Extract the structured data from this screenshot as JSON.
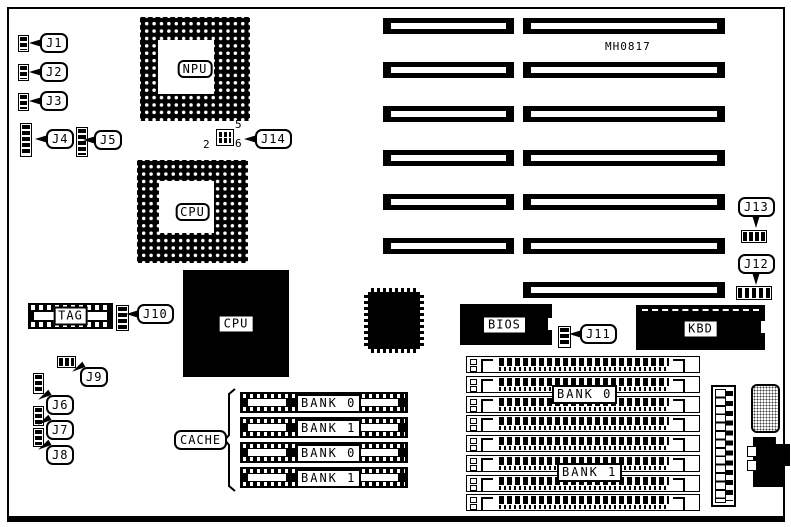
{
  "figure": {
    "part_number": "MH0817",
    "sockets": {
      "npu": "NPU",
      "cpu_upgrade": "CPU"
    },
    "chips": {
      "cpu": "CPU",
      "bios": "BIOS",
      "kbd": "KBD",
      "tag": "TAG"
    },
    "cache": {
      "label": "CACHE",
      "rows": [
        "BANK 0",
        "BANK 1",
        "BANK 0",
        "BANK 1"
      ]
    },
    "memory": {
      "rows": [
        "BANK 0",
        "BANK 1"
      ]
    },
    "jumpers": {
      "j1": "J1",
      "j2": "J2",
      "j3": "J3",
      "j4": "J4",
      "j5": "J5",
      "j6": "J6",
      "j7": "J7",
      "j8": "J8",
      "j9": "J9",
      "j10": "J10",
      "j11": "J11",
      "j12": "J12",
      "j13": "J13",
      "j14": "J14"
    },
    "j14_pins": {
      "top_right": "5",
      "bottom_left": "2",
      "bottom_right": "6"
    }
  }
}
